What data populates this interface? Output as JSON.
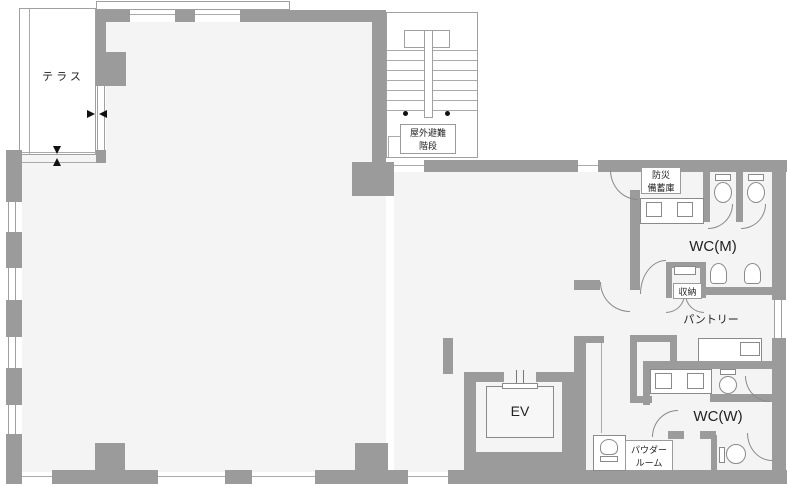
{
  "plan": {
    "type": "floor-plan",
    "colors": {
      "wall": "#9b9b9b",
      "floor": "#f4f4f4",
      "outside": "#ffffff",
      "text": "#222222"
    },
    "labels": {
      "terrace": "テラス",
      "stairs_line1": "屋外避難",
      "stairs_line2": "階段",
      "disaster_line1": "防災",
      "disaster_line2": "備蓄庫",
      "wc_m": "WC(M)",
      "storage": "収納",
      "pantry": "パントリー",
      "ev": "EV",
      "powder_line1": "パウダー",
      "powder_line2": "ルーム",
      "wc_w": "WC(W)"
    }
  }
}
